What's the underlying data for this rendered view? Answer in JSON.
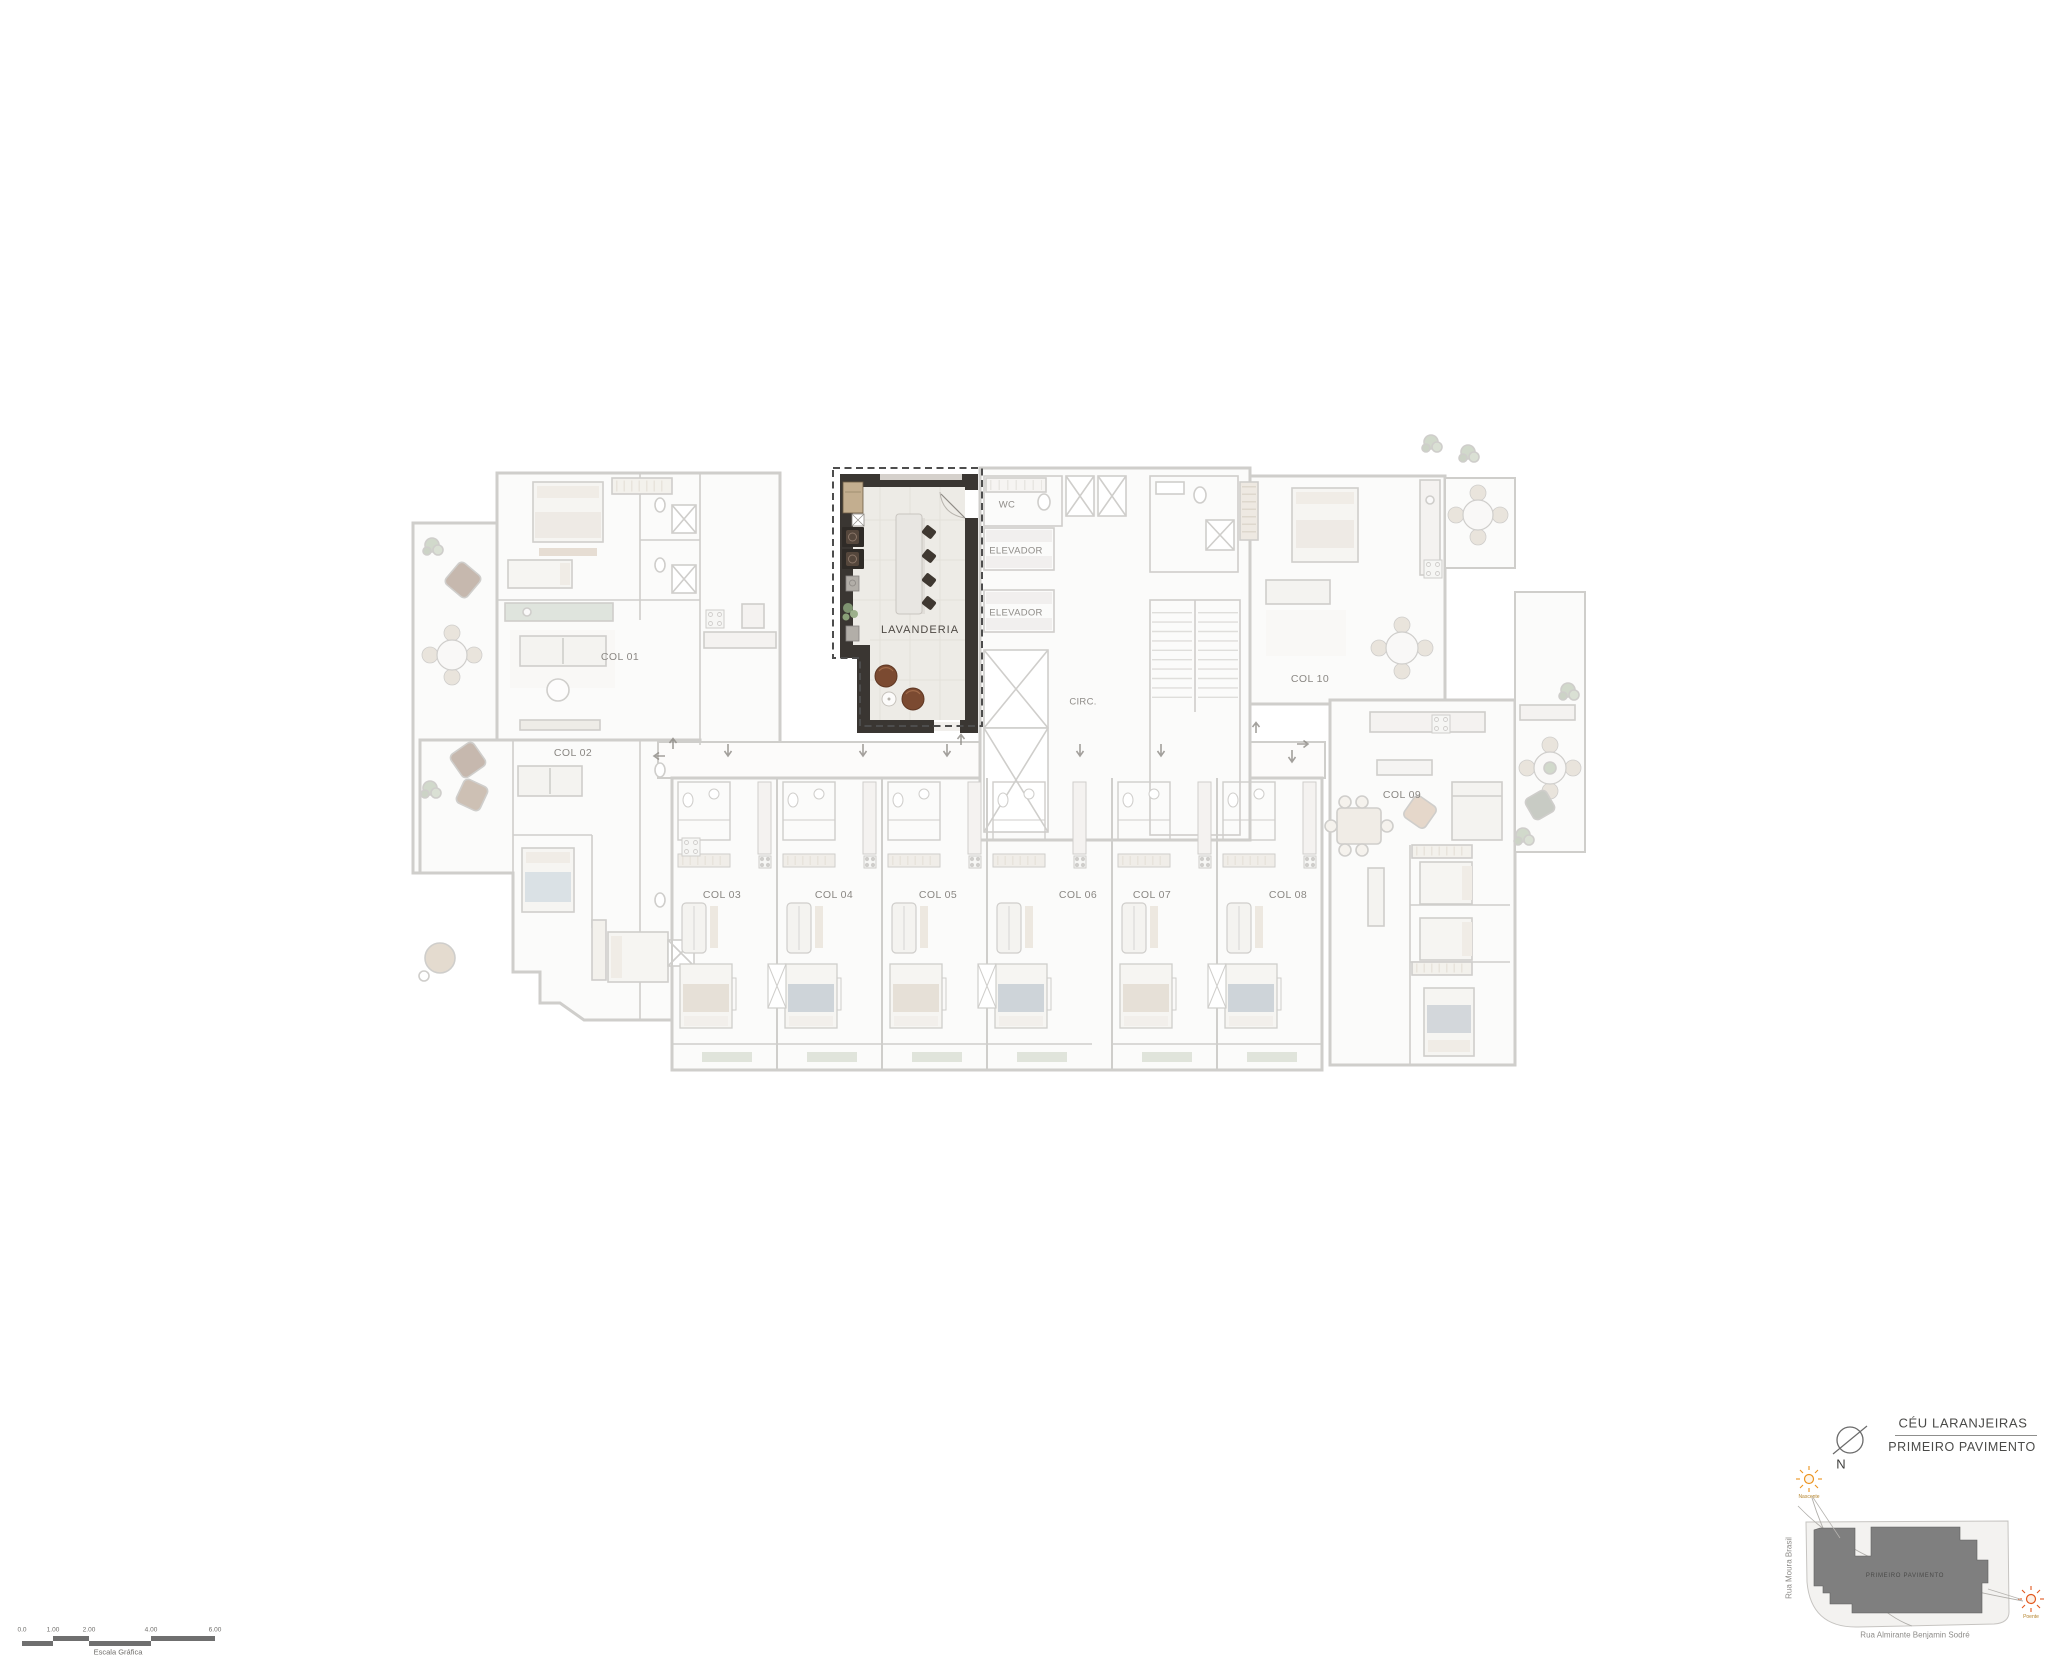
{
  "plan": {
    "highlight_label": "LAVANDERIA",
    "core": {
      "wc": "WC",
      "elevator_top": "ELEVADOR",
      "elevator_bottom": "ELEVADOR",
      "circulation": "CIRC."
    },
    "units": [
      {
        "label": "COL 01",
        "x": 620,
        "y": 657
      },
      {
        "label": "COL 02",
        "x": 573,
        "y": 753
      },
      {
        "label": "COL 03",
        "x": 722,
        "y": 895
      },
      {
        "label": "COL 04",
        "x": 834,
        "y": 895
      },
      {
        "label": "COL 05",
        "x": 938,
        "y": 895
      },
      {
        "label": "COL 06",
        "x": 1078,
        "y": 895
      },
      {
        "label": "COL 07",
        "x": 1152,
        "y": 895
      },
      {
        "label": "COL 08",
        "x": 1288,
        "y": 895
      },
      {
        "label": "COL 09",
        "x": 1402,
        "y": 795
      },
      {
        "label": "COL 10",
        "x": 1310,
        "y": 679
      }
    ]
  },
  "legend": {
    "project_title": "CÉU LARANJEIRAS",
    "floor_label": "PRIMEIRO PAVIMENTO",
    "compass": "N",
    "site_plan": {
      "building_label": "PRIMEIRO PAVIMENTO",
      "street_west": "Rua Moura Brasil",
      "street_south": "Rua Almirante Benjamin Sodré",
      "sunrise_label": "Nascente",
      "sunset_label": "Poente"
    }
  },
  "scale_bar": {
    "caption": "Escala Gráfica",
    "ticks": [
      {
        "label": "0.0",
        "x": 22
      },
      {
        "label": "1.00",
        "x": 53
      },
      {
        "label": "2.00",
        "x": 89
      },
      {
        "label": "4.00",
        "x": 151
      },
      {
        "label": "6.00",
        "x": 215
      }
    ]
  },
  "colors": {
    "highlight_wall": "#3a3632",
    "pouf": "#7b4a31",
    "sun": "#ec941f",
    "footprint": "#7f7f7f",
    "faded_wall": "#8f8b86"
  }
}
